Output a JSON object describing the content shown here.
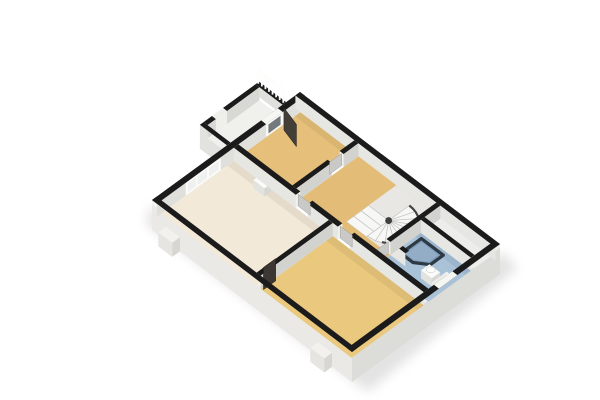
{
  "scene": {
    "description": "3D cutaway floor plan render of an upper floor, rotated diamond orientation, white background",
    "background": "#ffffff"
  },
  "palette": {
    "wall_cap": "#1b1b1b",
    "wall_face_light": "#e6e6e3",
    "wall_face_dark": "#d2d2cf",
    "facade_face": "#dfdfdc",
    "exterior_face_sw": "#eae9e5",
    "exterior_face_se": "#dcdcd8",
    "exterior_top_strip": "#f6f6f2",
    "shadow": "rgba(0,0,0,0.11)",
    "door_slab": "#c9c9c7",
    "door_slab_edge": "#9f9f9d",
    "door_dark_leaf": "#443e39",
    "window_frame": "#fbfbf9",
    "window_glass": "#eff1f0",
    "door_glass": "#73797c",
    "stair_tread": "#f7f7f5",
    "stair_edge": "#c2c2c0",
    "stair_stringer": "#454543",
    "fixture_white": "#fbfbf9",
    "fixture_shade": "#e2e2df",
    "fixture_side": "#d6d6d3",
    "shower_base": "#7e9bba",
    "shower_rim": "#2d3943",
    "railing_white": "#fdfdfc",
    "floor_shade": "rgba(60,45,10,0.07)"
  },
  "rooms": [
    {
      "id": "bedroom-top",
      "label": "small bedroom (top)",
      "floor": "#e6c07a"
    },
    {
      "id": "hallway",
      "label": "landing / hallway",
      "floor": "#e3bd77"
    },
    {
      "id": "stairwell",
      "label": "stairwell",
      "floor": "#e8e7e3"
    },
    {
      "id": "closet-strip",
      "label": "closet strip (top right)",
      "floor": "#ededeb"
    },
    {
      "id": "bathroom",
      "label": "bathroom",
      "floor": "#a9c2d8"
    },
    {
      "id": "bedroom-left",
      "label": "bedroom (left)",
      "floor": "#f2e9d9"
    },
    {
      "id": "living-room",
      "label": "large room (bottom)",
      "floor": "#eac87e"
    },
    {
      "id": "balcony",
      "label": "balcony",
      "floor": "#f0f0ed"
    }
  ],
  "fixtures": [
    {
      "id": "winder-staircase",
      "label": "U-winder staircase",
      "treads": 13
    },
    {
      "id": "corner-shower",
      "label": "corner shower"
    },
    {
      "id": "toilet",
      "label": "toilet"
    },
    {
      "id": "sink",
      "label": "wash basin"
    },
    {
      "id": "radiator",
      "label": "bathroom window / radiator panel"
    },
    {
      "id": "balcony-railing",
      "label": "balcony railing",
      "posts": 8
    },
    {
      "id": "triple-window",
      "label": "triple window",
      "panes": 3
    },
    {
      "id": "balcony-door",
      "label": "balcony door"
    },
    {
      "id": "interior-doors",
      "label": "interior door slabs",
      "count": 4
    },
    {
      "id": "open-dark-doors",
      "label": "dark open door leaves",
      "count": 2
    }
  ]
}
